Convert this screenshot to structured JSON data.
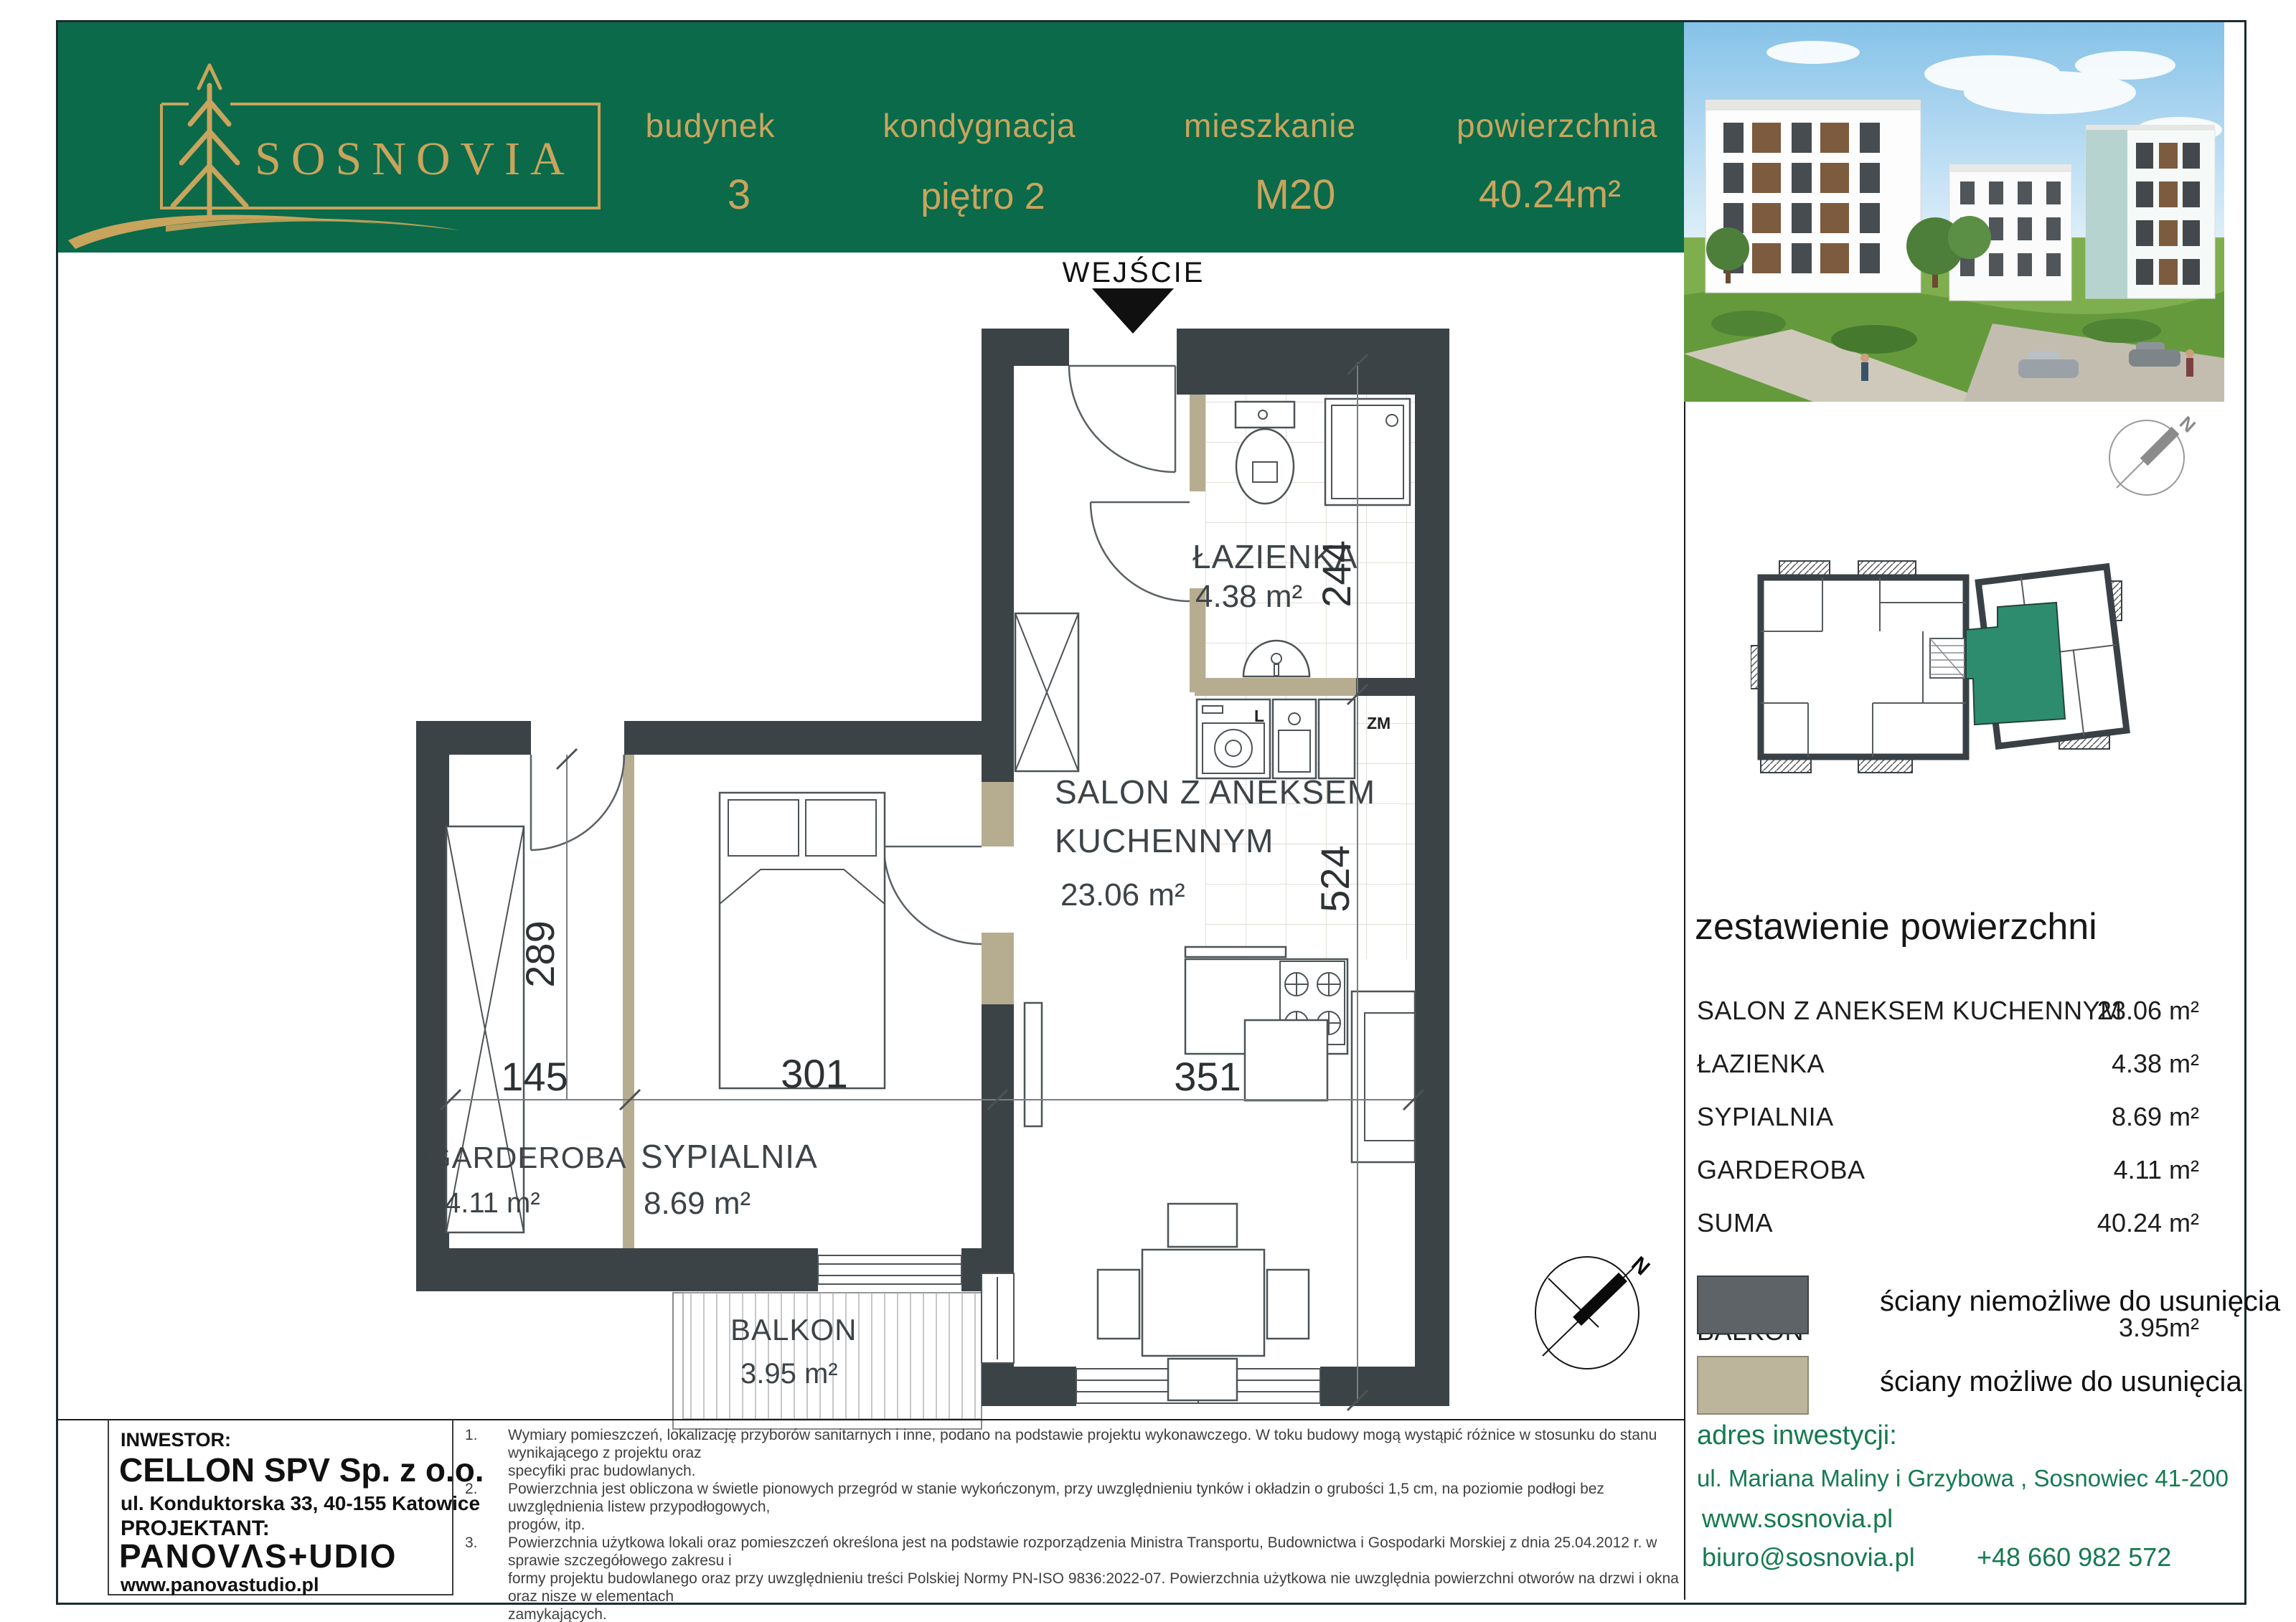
{
  "header": {
    "brand": "SOSNOVIA",
    "columns": [
      {
        "label": "budynek",
        "value": "3"
      },
      {
        "label": "kondygnacja",
        "value": "piętro 2"
      },
      {
        "label": "mieszkanie",
        "value": "M20"
      },
      {
        "label": "powierzchnia",
        "value": "40.24m²"
      }
    ]
  },
  "plan": {
    "entry_label": "WEJŚCIE",
    "rooms": {
      "bathroom": {
        "name": "ŁAZIENKA",
        "area": "4.38 m²"
      },
      "salon_line1": "SALON Z ANEKSEM",
      "salon_line2": "KUCHENNYM",
      "salon_area": "23.06 m²",
      "bedroom": {
        "name": "SYPIALNIA",
        "area": "8.69 m²"
      },
      "wardrobe": {
        "name": "GARDEROBA",
        "area": "4.11 m²"
      },
      "balcony": {
        "name": "BALKON",
        "area": "3.95 m²"
      }
    },
    "dims": {
      "d244": "244",
      "d524": "524",
      "d289": "289",
      "d145": "145",
      "d301": "301",
      "d351": "351"
    },
    "markers": {
      "washer": "L",
      "sink": "ZM"
    }
  },
  "area_table": {
    "title": "zestawienie powierzchni",
    "rows": [
      {
        "label": "SALON Z ANEKSEM KUCHENNYM",
        "value": "23.06 m²"
      },
      {
        "label": "ŁAZIENKA",
        "value": "4.38 m²"
      },
      {
        "label": "SYPIALNIA",
        "value": "8.69 m²"
      },
      {
        "label": "GARDEROBA",
        "value": "4.11 m²"
      },
      {
        "label": "SUMA",
        "value": "40.24 m²"
      },
      {
        "label": "BALKON",
        "value": "3.95m²"
      }
    ]
  },
  "legend": {
    "fixed": "ściany niemożliwe do usunięcia",
    "removable": "ściany możliwe do usunięcia"
  },
  "compass": {
    "north": "N"
  },
  "sidebar": {
    "address_heading": "adres inwestycji:",
    "address": "ul. Mariana Maliny i Grzybowa , Sosnowiec 41-200",
    "website": "www.sosnovia.pl",
    "email": "biuro@sosnovia.pl",
    "phone": "+48 660 982 572"
  },
  "footer": {
    "investor_heading": "INWESTOR:",
    "investor_name": "CELLON SPV  Sp. z o.o.",
    "investor_address": "ul. Konduktorska 33, 40-155 Katowice",
    "designer_heading": "PROJEKTANT:",
    "designer_logo": "PANOVΛS+UDIO",
    "designer_site": "www.panovastudio.pl",
    "notes": [
      {
        "n": "1.",
        "text": "Wymiary pomieszczeń, lokalizację przyborów sanitarnych i inne, podano na podstawie projektu wykonawczego. W toku budowy mogą wystąpić różnice w stosunku do stanu wynikającego z projektu oraz\nspecyfiki prac budowlanych."
      },
      {
        "n": "2.",
        "text": "Powierzchnia jest obliczona w świetle pionowych przegród w stanie wykończonym, przy uwzględnieniu tynków i okładzin o grubości 1,5 cm, na poziomie podłogi bez uwzględnienia listew przypodłogowych,\nprogów, itp."
      },
      {
        "n": "3.",
        "text": "Powierzchnia użytkowa lokali oraz pomieszczeń określona jest na podstawie rozporządzenia Ministra Transportu, Budownictwa i Gospodarki Morskiej z dnia 25.04.2012 r. w sprawie szczegółowego zakresu i\nformy projektu budowlanego oraz przy uwzględnieniu treści Polskiej Normy PN-ISO 9836:2022-07. Powierzchnia użytkowa nie uwzględnia powierzchni otworów na drzwi i okna oraz nisze w elementach\nzamykających."
      },
      {
        "n": "4.",
        "text": "Aranżacja meblowa wnętrz jest przykładowa."
      }
    ]
  }
}
